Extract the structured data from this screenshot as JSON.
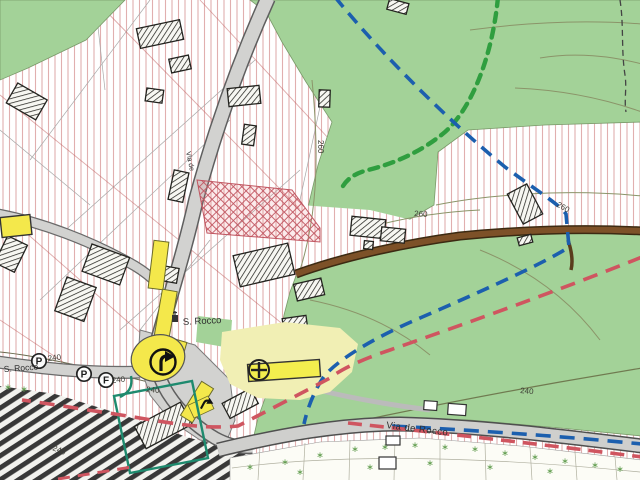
{
  "map": {
    "labels": {
      "s_rocco_main": "S. Rocco",
      "s_rocco_west": "S. Rocco",
      "via_de_rocco": "Via de Rocco",
      "via_side_street": "Via de"
    },
    "contours": {
      "c260_center": "260",
      "c260_mid": "260",
      "c260_east": "260",
      "c240_southeast": "240",
      "c240_west_a": "240",
      "c240_west_b": "240",
      "c240_site": "240",
      "c240_rail": "240"
    },
    "symbols": {
      "parking_a": "P",
      "parking_b": "P",
      "fountain": "F",
      "church_cross_icon": "circled-cross-church",
      "roundabout_arrow_icon": "turn-right-arrow",
      "driveway_arrow_icon": "turn-right-arrow-small",
      "tree": "∗"
    },
    "colors": {
      "vegetation_green": "#a3d298",
      "highlight_yellow": "#f4e84b",
      "pale_yellow": "#f1efb4",
      "route_blue": "#1c5fae",
      "route_red": "#cf5560",
      "boundary_green": "#2f9e3f",
      "site_teal": "#1e8a6e",
      "track_brown": "#7d5128",
      "road_gray": "#d2d2d0",
      "hatch_red": "#c05560"
    }
  }
}
